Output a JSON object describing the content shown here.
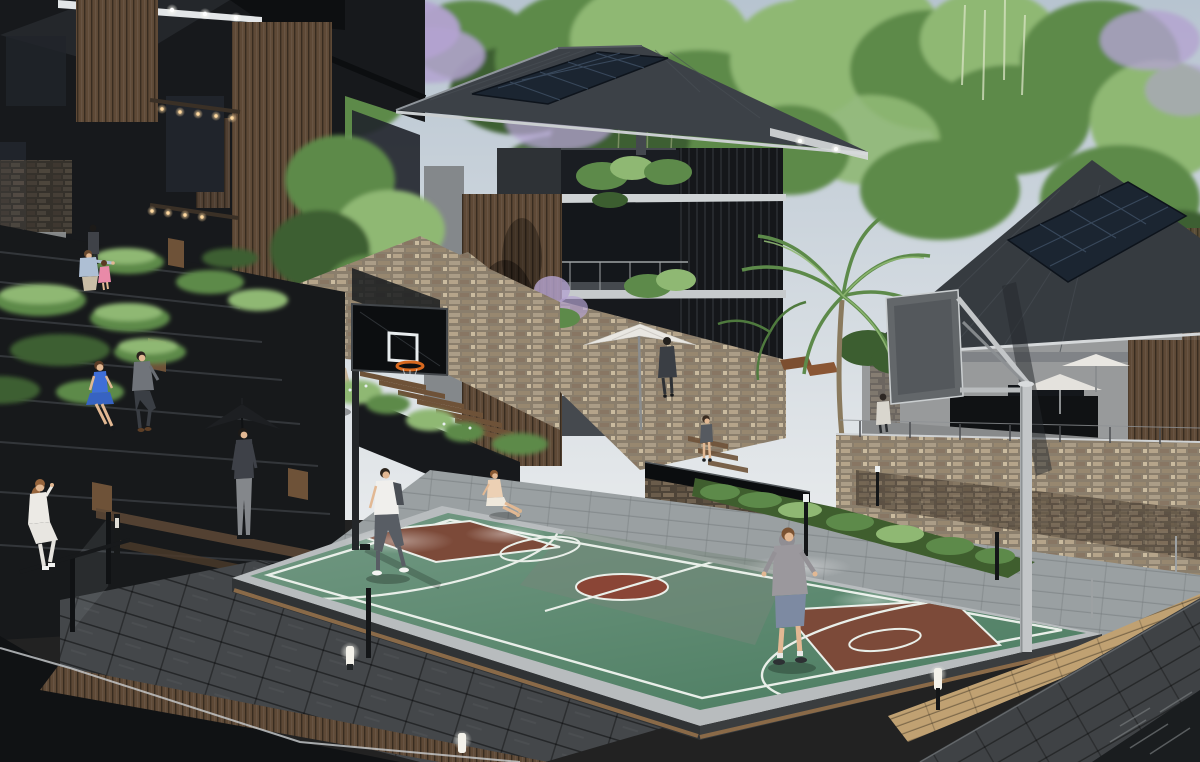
{
  "meta": {
    "type": "architectural-3d-render",
    "description": "Daytime 3D visualization of a modern hillside residential complex with terraced amphitheater seating, stacked-stone retaining walls and a sunken basketball court plaza",
    "width_px": 1200,
    "height_px": 762
  },
  "scene": {
    "setting": "hillside residential courtyard with basketball court",
    "elements": [
      {
        "name": "left-building-cluster",
        "desc": "dark charcoal multi-storey homes with vertical timber slats, lit soffits and warm downlights"
      },
      {
        "name": "center-house",
        "desc": "charcoal hip-roof villa with rooftop solar panels, timber feature wall, stacked balconies with planters and a white patio umbrella"
      },
      {
        "name": "right-house",
        "desc": "grey two-storey house with dark hip roof, solar array and timber-slat wing"
      },
      {
        "name": "stone-retaining-walls",
        "desc": "tan stacked-stone walls stepping down the slope with glass guard rails"
      },
      {
        "name": "amphitheater-steps",
        "desc": "black terraced seating steps with timber caps and clipped green hedges"
      },
      {
        "name": "center-stair",
        "desc": "timber-tread staircase beside a tan boulder and shrubs"
      },
      {
        "name": "basketball-court",
        "desc": "green sport court, brown painted keys, rust center circle, white line markings, raised grey curb with timber trim"
      },
      {
        "name": "hoop-left",
        "desc": "black glass backboard with white shooter square and orange rim on dark pole"
      },
      {
        "name": "hoop-right",
        "desc": "grey backboard seen from behind with silver cantilever arm and pole"
      },
      {
        "name": "palm-tree",
        "desc": "single palm with arcing fronds in front of right house"
      },
      {
        "name": "water-feature",
        "desc": "dark reflective basin on stone plinth behind the court"
      },
      {
        "name": "wood-deck",
        "desc": "warm timber boardwalk along right court edge with white capped glass rail"
      },
      {
        "name": "pool",
        "desc": "dark water surface with ripples at lower right"
      },
      {
        "name": "sunken-pit",
        "desc": "dark void at lower left edged by a curved vertical-slat timber wall"
      },
      {
        "name": "paving",
        "desc": "large-format grey stone pavers around the court"
      },
      {
        "name": "vegetation",
        "desc": "tree canopy with jacaranda purple blossoms, light bamboo stand and mixed greens"
      },
      {
        "name": "lighting",
        "desc": "glowing white bollard lights and black fence posts with lit tips"
      },
      {
        "name": "car",
        "desc": "black sedan parked under the left building"
      }
    ],
    "people": [
      {
        "name": "man-standing-driveway",
        "desc": "man in dark top near parked car"
      },
      {
        "name": "parent-with-child",
        "desc": "crouching adult in light blue with small girl in pink dress"
      },
      {
        "name": "woman-blue-dress",
        "desc": "seated on amphitheater step"
      },
      {
        "name": "man-grey-suit",
        "desc": "seated beside her"
      },
      {
        "name": "man-standing-terrace",
        "desc": "standing near black umbrella"
      },
      {
        "name": "woman-white-outfit",
        "desc": "seated on lower step, far left"
      },
      {
        "name": "player-white-tee",
        "desc": "walking across court near left key"
      },
      {
        "name": "kid-sitting-courtside",
        "desc": "child seated on court edge"
      },
      {
        "name": "boy-grey-hoodie",
        "desc": "boy in denim shorts standing on right side of court"
      },
      {
        "name": "toddler-on-steps",
        "desc": "small child by garden steps"
      },
      {
        "name": "man-under-umbrella",
        "desc": "walking by white patio umbrella"
      },
      {
        "name": "person-on-balcony",
        "desc": "figure at center-house balcony"
      },
      {
        "name": "person-by-patio",
        "desc": "light-shirt figure behind stone wall"
      }
    ]
  },
  "palette": {
    "sky_top": "#b7c4d0",
    "sky_bottom": "#e7eaec",
    "foliage_dark": "#3c5e30",
    "foliage_mid": "#5d8a4a",
    "foliage_light": "#8fb873",
    "blossom_purple": "#b3a2d0",
    "building_dark": "#17191c",
    "building_charcoal": "#26292d",
    "wood_slat": "#5e4936",
    "center_roof": "#3c4147",
    "right_roof": "#363b40",
    "solar_panel": "#1b2531",
    "house_wall": "#45494e",
    "right_wall": "#989a9b",
    "stone_light": "#ab9d87",
    "court_green": "#4f7f64",
    "court_key": "#7c4a39",
    "court_center": "#8a4536",
    "court_line": "#e9efe9",
    "court_curb": "#b8bcbe",
    "apron_grey": "#9aa0a2",
    "plaza_grey": "#8f9496",
    "deck_wood": "#c0a172",
    "rail_white": "#eceef0",
    "paving_dark": "#44474a",
    "pit_black": "#101214",
    "step_black": "#17191b",
    "bench_wood": "#6e5238",
    "boulder_tan": "#c6b298",
    "umbrella_black": "#1d1f22",
    "umbrella_white": "#e9e7e2",
    "hoop_board_black": "#0c0e10",
    "hoop_rim_orange": "#d8691f",
    "hoop_pole_grey": "#c3c6c8",
    "pool_dark": "#1a1d1f",
    "skin": "#e2b893",
    "blue_dress": "#3f6fd8",
    "suit_grey": "#70747a",
    "hoodie_grey": "#9b989d",
    "glow_warm": "#ffd9a0",
    "light_white": "#f4f2ea"
  }
}
